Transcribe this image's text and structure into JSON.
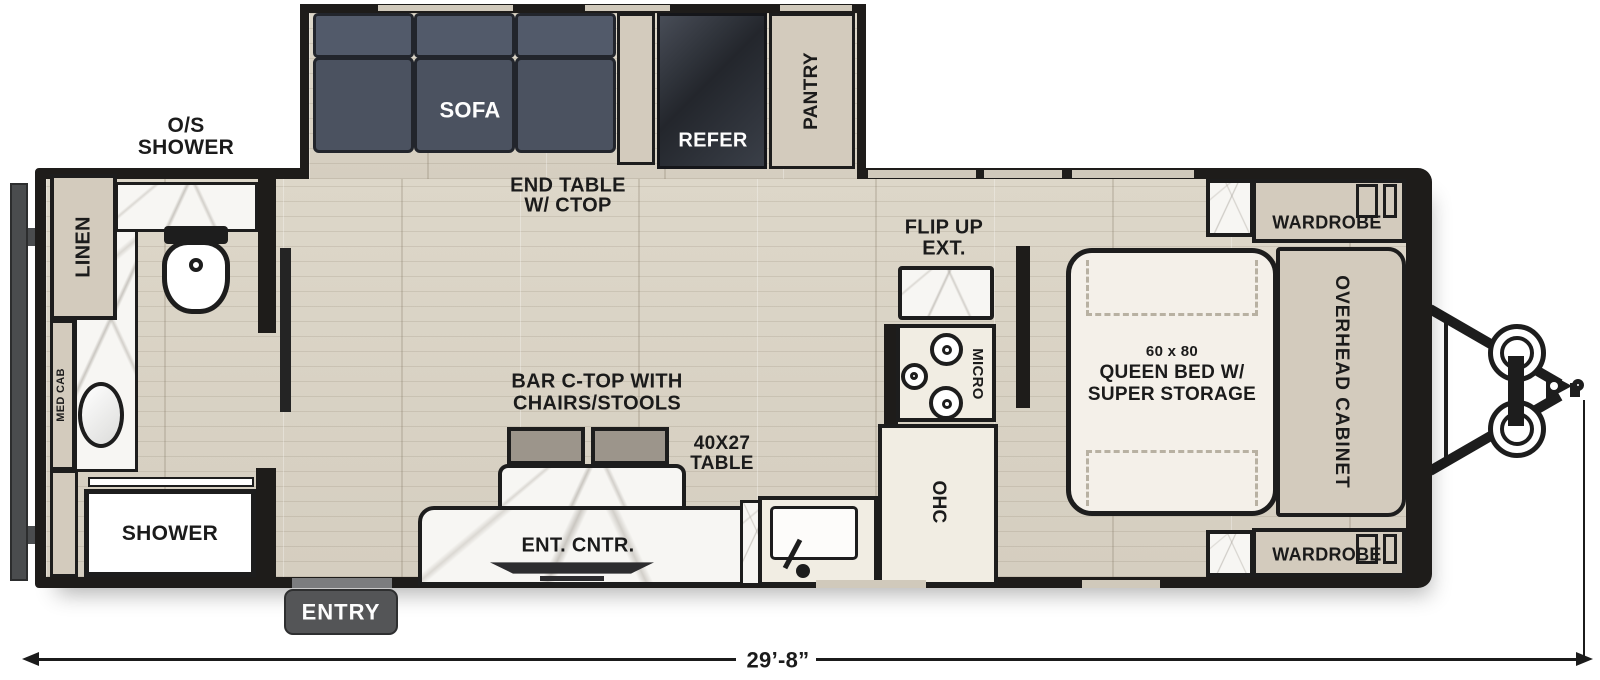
{
  "title": "Travel trailer floor plan",
  "colors": {
    "wall": "#1e1c1a",
    "floor": "#d8d2c3",
    "cabinet_beige": "#d3cbbd",
    "counter_cream": "#f1ede3",
    "sofa": "#4b5260",
    "refer_dark": "#2e323b",
    "chair_gray": "#9c958b",
    "entry_badge": "#545557",
    "bumper_gray": "#4a4c4e",
    "label_text": "#1b1b1b",
    "label_text_light": "#fdfdfd"
  },
  "labels": {
    "os_shower_line1": "O/S",
    "os_shower_line2": "SHOWER",
    "sofa": "SOFA",
    "end_table_line1": "END TABLE",
    "end_table_line2": "W/ CTOP",
    "refer": "REFER",
    "pantry": "PANTRY",
    "flip_up_line1": "FLIP UP",
    "flip_up_line2": "EXT.",
    "wardrobe_top": "WARDROBE",
    "wardrobe_bottom": "WARDROBE",
    "overhead_cabinet": "OVERHEAD CABINET",
    "bed_size": "60 x 80",
    "bed_line1": "QUEEN BED W/",
    "bed_line2": "SUPER STORAGE",
    "linen": "LINEN",
    "med_cab": "MED CAB",
    "shower": "SHOWER",
    "entry": "ENTRY",
    "bar_line1": "BAR C-TOP WITH",
    "bar_line2": "CHAIRS/STOOLS",
    "table_line1": "40X27",
    "table_line2": "TABLE",
    "ent_cntr": "ENT. CNTR.",
    "micro": "MICRO",
    "ohc": "OHC",
    "length": "29’-8”"
  }
}
